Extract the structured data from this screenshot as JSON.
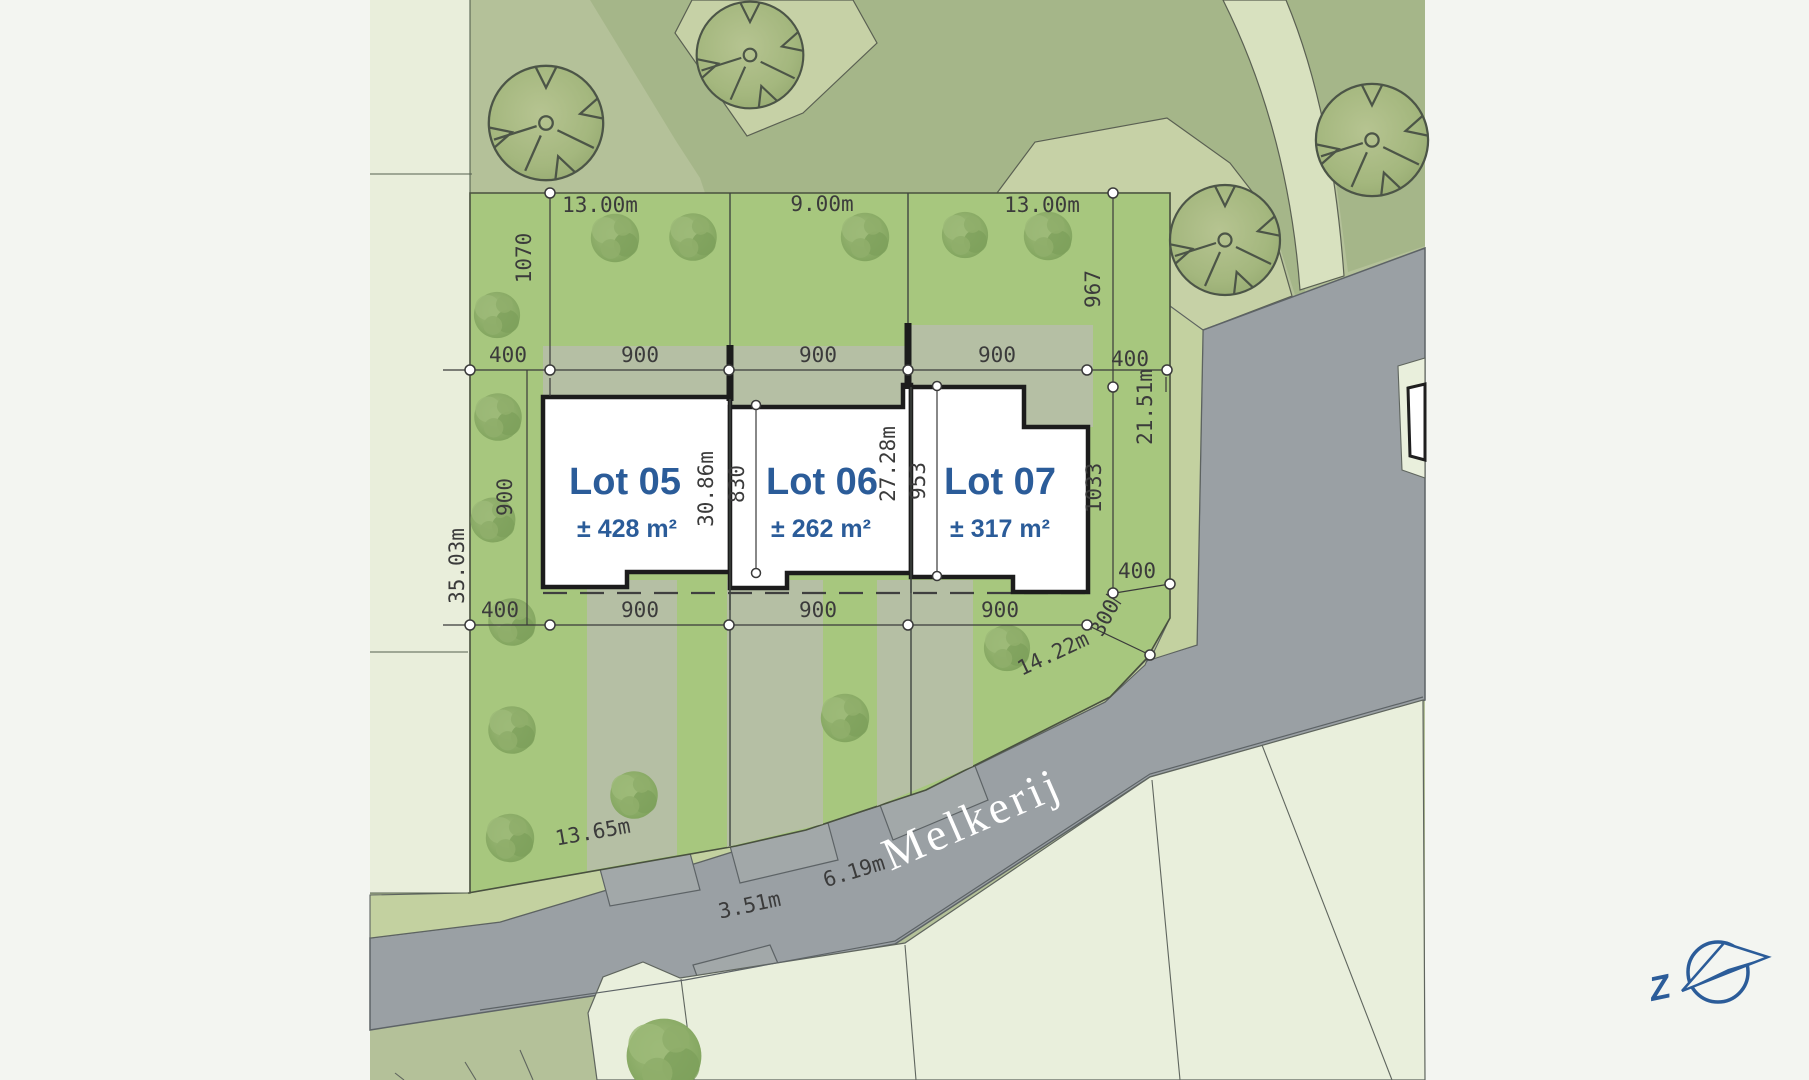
{
  "site_plan": {
    "street_name": "Melkerij",
    "compass_label": "Z",
    "lots": [
      {
        "name": "Lot 05",
        "area": "± 428 m²"
      },
      {
        "name": "Lot 06",
        "area": "± 262 m²"
      },
      {
        "name": "Lot 07",
        "area": "± 317 m²"
      }
    ],
    "garden_widths": [
      "13.00m",
      "9.00m",
      "13.00m"
    ],
    "upper_chain": [
      "400",
      "900",
      "900",
      "900",
      "400"
    ],
    "lower_chain": [
      "400",
      "900",
      "900",
      "900"
    ],
    "left_dims": {
      "rear_depth": "1070",
      "front_depth": "900",
      "boundary_length": "35.03m"
    },
    "right_dims": {
      "rear_depth": "967",
      "front_depth": "1033",
      "boundary_length": "21.51m",
      "offset": "400",
      "corner": "300"
    },
    "party_dims": {
      "lot05_06_boundary": "30.86m",
      "lot06_house_depth": "830",
      "lot06_07_boundary": "27.28m",
      "lot07_house_depth": "953"
    },
    "frontage_dims": [
      "13.65m",
      "3.51m",
      "6.19m",
      "14.22m"
    ]
  },
  "colors": {
    "accent_blue": "#2b5c99",
    "parcel_green": "#a7c77e",
    "road_gray": "#9aa0a4",
    "sage": "#b4c199",
    "pale_parcel": "#e9efdc"
  }
}
